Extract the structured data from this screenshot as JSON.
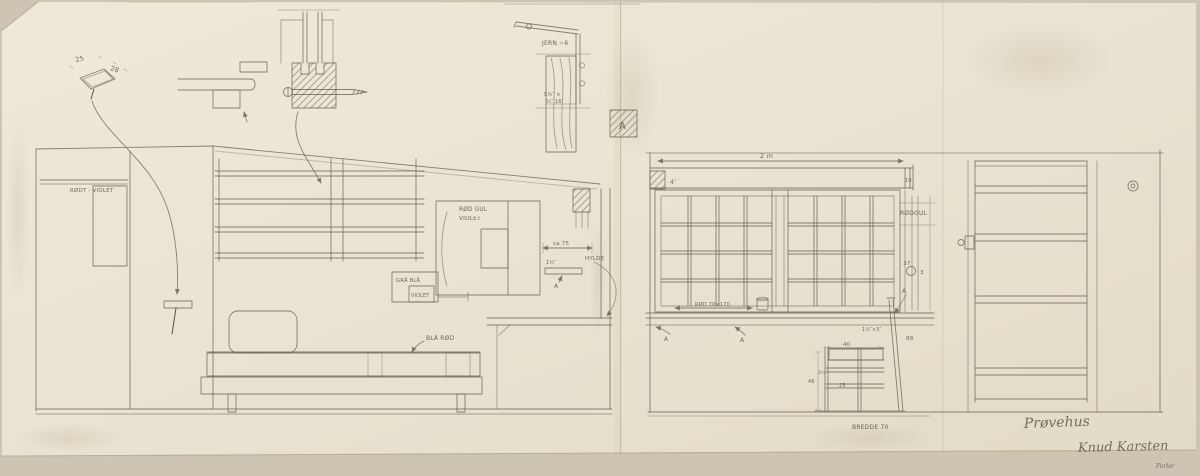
{
  "artwork": {
    "type": "hand-drawn architectural pencil sketch, interior elevations of a test house",
    "title": "Prøvehus",
    "signature": "Knud Karsten",
    "corner_note": "Forler"
  },
  "colors": {
    "paper": "#eae3d1",
    "backing": "#cdc5b2",
    "pencil": "#6b6352",
    "pencil_dark": "#3e3930",
    "text": "#5b5346"
  },
  "labels": {
    "marker_a": "A",
    "top_left_sketch": {
      "dim_w": "25",
      "dim_d": "28"
    },
    "iron_detail": {
      "name": "JERN ~6",
      "post_dim_line1": "5½″ ×",
      "post_dim_line2": "¾″ 16″"
    },
    "left_elevation": {
      "closet": "RØDT - VIOLET",
      "cabinet_line1": "RØD GUL",
      "cabinet_line2": "VIOLET",
      "box_line1": "GRÅ BLÅ",
      "box_line2": "VIOLET",
      "bench": "BLÅ RØD",
      "shelf_width": "ca 75",
      "shelf_thickness": "1½″",
      "shelf": "HYLDE"
    },
    "right_elevation": {
      "beam_length": "2 m",
      "beam_height": "4″",
      "beam_end": "10",
      "window_color": "RØDGUL",
      "window_size": "RØD 70×170",
      "dim_37": "37",
      "dim_3": "3",
      "dim_88": "88",
      "chair_seat_width": "40",
      "chair_slat": "1½″×3″",
      "chair_height": "46",
      "chair_dim_3half": "3½",
      "chair_dim_25": "25",
      "chair_width": "BREDDE 70"
    }
  }
}
